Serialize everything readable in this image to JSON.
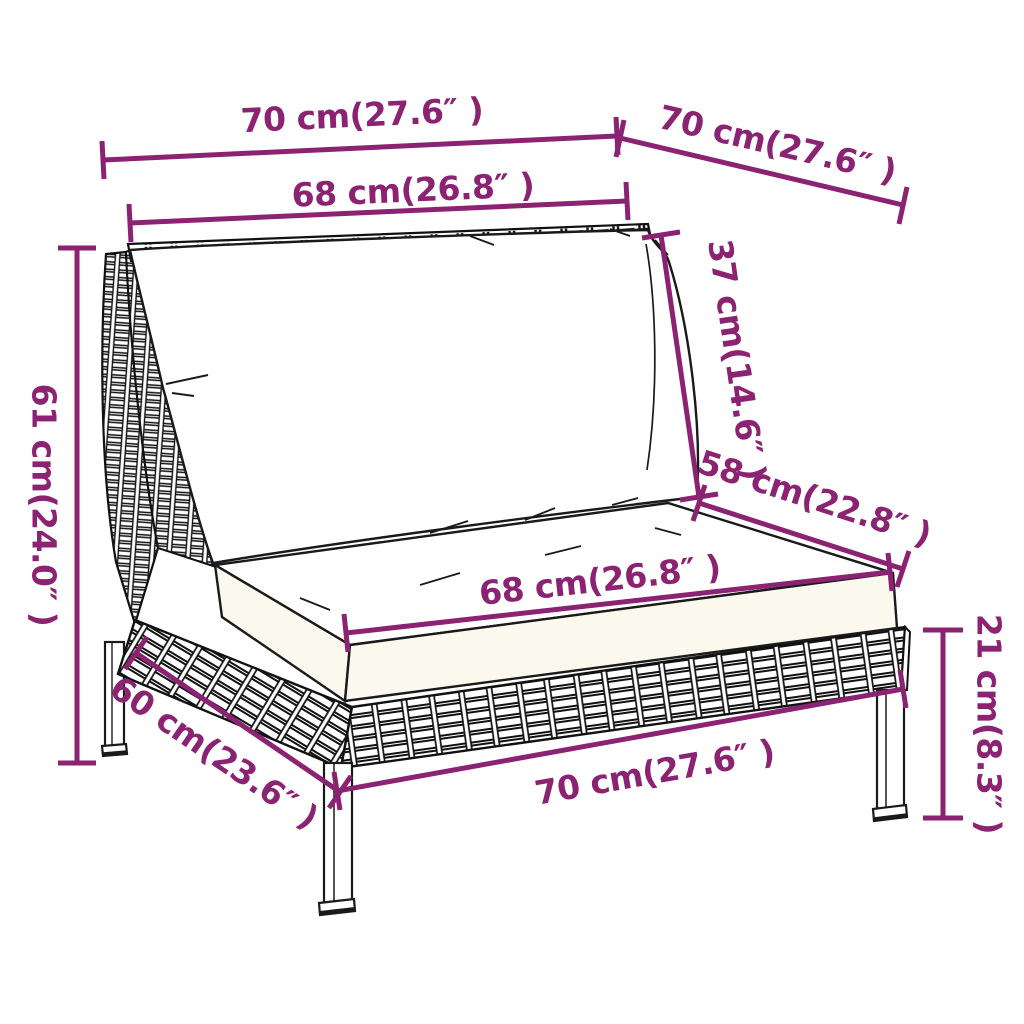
{
  "figure": {
    "kind": "furniture-dimension-diagram",
    "accent_color": "#8B2272",
    "line_art_color": "#1a1a1a",
    "background_color": "#ffffff",
    "units": [
      "cm",
      "in"
    ]
  },
  "dims": {
    "top_width": {
      "cm": 70,
      "in": 27.6,
      "label": "70 cm(27.6″ )"
    },
    "top_depth": {
      "cm": 70,
      "in": 27.6,
      "label": "70 cm(27.6″ )"
    },
    "back_cushion_width": {
      "cm": 68,
      "in": 26.8,
      "label": "68 cm(26.8″ )"
    },
    "total_height": {
      "cm": 61,
      "in": 24.0,
      "label": "61 cm(24.0″ )"
    },
    "back_cushion_height": {
      "cm": 37,
      "in": 14.6,
      "label": "37 cm(14.6″ )"
    },
    "seat_depth": {
      "cm": 58,
      "in": 22.8,
      "label": "58 cm(22.8″ )"
    },
    "seat_cushion_width": {
      "cm": 68,
      "in": 26.8,
      "label": "68 cm(26.8″ )"
    },
    "base_depth": {
      "cm": 60,
      "in": 23.6,
      "label": "60 cm(23.6″ )"
    },
    "base_width": {
      "cm": 70,
      "in": 27.6,
      "label": "70 cm(27.6″ )"
    },
    "leg_height": {
      "cm": 21,
      "in": 8.3,
      "label": "21 cm(8.3″ )"
    }
  }
}
